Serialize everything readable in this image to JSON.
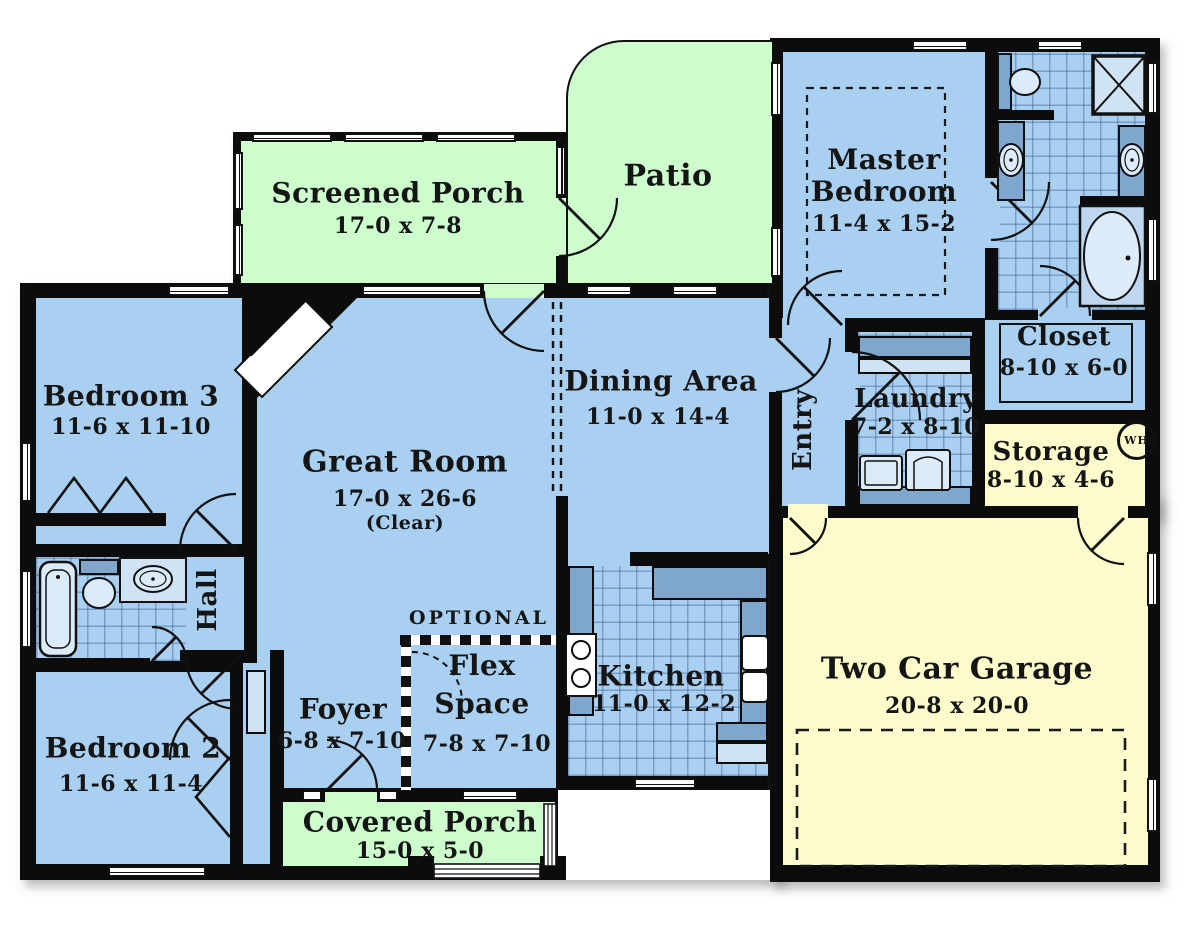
{
  "plan": {
    "type": "floor-plan",
    "colors": {
      "room_blue": "#A9CFF1",
      "porch_green": "#CDFDCD",
      "garage_yellow": "#FDFACC",
      "wall_black": "#0c0c0c",
      "counter_blue": "#7fa6cc"
    }
  },
  "rooms": [
    {
      "id": "screened-porch",
      "name": "Screened Porch",
      "dims": "17-0 x 7-8"
    },
    {
      "id": "patio",
      "name": "Patio",
      "dims": ""
    },
    {
      "id": "master-bedroom",
      "name": "Master Bedroom",
      "dims": "11-4 x 15-2"
    },
    {
      "id": "closet",
      "name": "Closet",
      "dims": "8-10 x 6-0"
    },
    {
      "id": "storage",
      "name": "Storage",
      "dims": "8-10 x 4-6"
    },
    {
      "id": "laundry",
      "name": "Laundry",
      "dims": "7-2 x 8-10"
    },
    {
      "id": "entry",
      "name": "Entry",
      "dims": ""
    },
    {
      "id": "dining-area",
      "name": "Dining Area",
      "dims": "11-0 x 14-4"
    },
    {
      "id": "kitchen",
      "name": "Kitchen",
      "dims": "11-0 x 12-2"
    },
    {
      "id": "great-room",
      "name": "Great Room",
      "dims": "17-0 x 26-6",
      "note": "(Clear)"
    },
    {
      "id": "bedroom-3",
      "name": "Bedroom 3",
      "dims": "11-6 x 11-10"
    },
    {
      "id": "hall",
      "name": "Hall",
      "dims": ""
    },
    {
      "id": "bedroom-2",
      "name": "Bedroom 2",
      "dims": "11-6 x 11-4"
    },
    {
      "id": "foyer",
      "name": "Foyer",
      "dims": "6-8 x 7-10"
    },
    {
      "id": "flex-space",
      "name": "Flex Space",
      "dims": "7-8 x 7-10",
      "note": "OPTIONAL"
    },
    {
      "id": "covered-porch",
      "name": "Covered Porch",
      "dims": "15-0 x 5-0"
    },
    {
      "id": "two-car-garage",
      "name": "Two Car Garage",
      "dims": "20-8 x 20-0"
    }
  ],
  "annotations": {
    "water_heater": "WH"
  }
}
